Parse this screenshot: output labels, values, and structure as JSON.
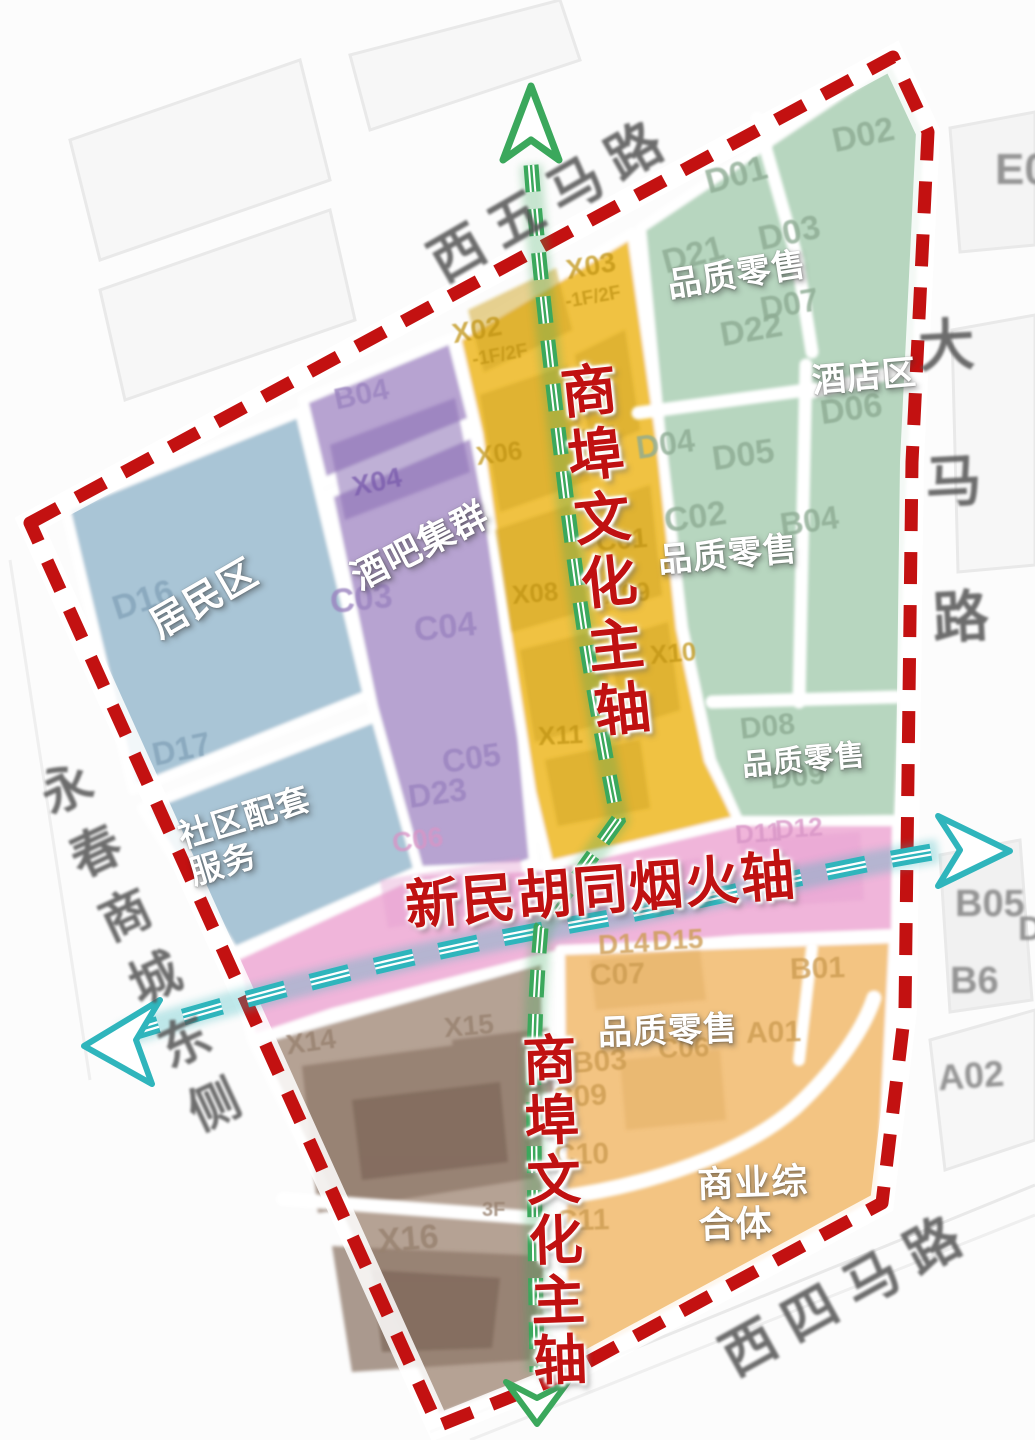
{
  "streets": {
    "top": "西五马路",
    "right": "大马路",
    "left": "永春商城东侧",
    "bottom": "西四马路"
  },
  "axes": {
    "vertical_top": "商埠文化主轴",
    "vertical_bottom": "商埠文化主轴",
    "horizontal": "新民胡同烟火轴"
  },
  "area_labels": {
    "residential": "居民区",
    "community_line1": "社区配套",
    "community_line2": "服务",
    "bar_cluster": "酒吧集群",
    "retail_top": "品质零售",
    "hotel": "酒店区",
    "retail_mid": "品质零售",
    "retail_low": "品质零售",
    "retail_south": "品质零售",
    "complex_line1": "商业综",
    "complex_line2": "合体"
  },
  "colors": {
    "boundary_red": "#c31111",
    "axis_green": "#3ba85c",
    "axis_cyan": "#2fb5bc",
    "axis_text_red": "#c01111",
    "zone_blue": "#a9c5d6",
    "zone_purple": "#b7a3d1",
    "zone_yellow": "#f0c243",
    "zone_green": "#b7d6bf",
    "zone_pink": "#f0b5da",
    "zone_orange": "#f3c482",
    "zone_brown": "#b5a294",
    "road_white": "#ffffff"
  },
  "blocks": [
    {
      "t": "D16",
      "x": 112,
      "y": 583,
      "r": -18,
      "fs": 34,
      "cls": "c-blue"
    },
    {
      "t": "D17",
      "x": 152,
      "y": 733,
      "r": -12,
      "fs": 32,
      "cls": "c-blue"
    },
    {
      "t": "B04",
      "x": 334,
      "y": 380,
      "r": -12,
      "fs": 30,
      "cls": "c-purple"
    },
    {
      "t": "X04",
      "x": 352,
      "y": 468,
      "r": -12,
      "fs": 28,
      "cls": "c-purple-dk"
    },
    {
      "t": "C03",
      "x": 330,
      "y": 582,
      "r": -6,
      "fs": 34,
      "cls": "c-purple"
    },
    {
      "t": "C04",
      "x": 414,
      "y": 610,
      "r": -6,
      "fs": 34,
      "cls": "c-purple"
    },
    {
      "t": "C05",
      "x": 442,
      "y": 742,
      "r": -8,
      "fs": 32,
      "cls": "c-purple"
    },
    {
      "t": "D23",
      "x": 408,
      "y": 777,
      "r": -8,
      "fs": 32,
      "cls": "c-purple"
    },
    {
      "t": "X02",
      "x": 452,
      "y": 316,
      "r": -10,
      "fs": 28,
      "cls": "c-yellow-dk"
    },
    {
      "t": "-1F/2F",
      "x": 472,
      "y": 346,
      "r": -10,
      "fs": 19,
      "cls": "c-yellow-dk"
    },
    {
      "t": "X03",
      "x": 566,
      "y": 252,
      "r": -10,
      "fs": 28,
      "cls": "c-yellow-dk"
    },
    {
      "t": "-1F/2F",
      "x": 565,
      "y": 288,
      "r": -10,
      "fs": 19,
      "cls": "c-yellow-dk"
    },
    {
      "t": "X06",
      "x": 476,
      "y": 440,
      "r": -8,
      "fs": 26,
      "cls": "c-yellow-dk"
    },
    {
      "t": "X07",
      "x": 570,
      "y": 424,
      "r": -8,
      "fs": 26,
      "cls": "c-yellow-dk"
    },
    {
      "t": "C01",
      "x": 596,
      "y": 526,
      "r": -5,
      "fs": 28,
      "cls": "c-yellow-dk"
    },
    {
      "t": "X08",
      "x": 512,
      "y": 580,
      "r": -5,
      "fs": 26,
      "cls": "c-yellow-dk"
    },
    {
      "t": "X09",
      "x": 604,
      "y": 580,
      "r": -5,
      "fs": 26,
      "cls": "c-yellow-dk"
    },
    {
      "t": "X10",
      "x": 650,
      "y": 640,
      "r": -5,
      "fs": 26,
      "cls": "c-yellow-dk"
    },
    {
      "t": "X11",
      "x": 538,
      "y": 722,
      "r": -3,
      "fs": 26,
      "cls": "c-yellow-dk"
    },
    {
      "t": "D01",
      "x": 705,
      "y": 158,
      "r": -15,
      "fs": 34,
      "cls": "c-green-dk"
    },
    {
      "t": "D02",
      "x": 832,
      "y": 118,
      "r": -12,
      "fs": 34,
      "cls": "c-green-dk"
    },
    {
      "t": "D21",
      "x": 662,
      "y": 238,
      "r": -15,
      "fs": 34,
      "cls": "c-green-dk"
    },
    {
      "t": "D03",
      "x": 758,
      "y": 216,
      "r": -12,
      "fs": 34,
      "cls": "c-green-dk"
    },
    {
      "t": "D07",
      "x": 760,
      "y": 288,
      "r": -10,
      "fs": 32,
      "cls": "c-green-dk"
    },
    {
      "t": "D22",
      "x": 720,
      "y": 313,
      "r": -10,
      "fs": 34,
      "cls": "c-green-dk"
    },
    {
      "t": "D06",
      "x": 820,
      "y": 392,
      "r": -8,
      "fs": 34,
      "cls": "c-green-dk"
    },
    {
      "t": "D04",
      "x": 636,
      "y": 428,
      "r": -8,
      "fs": 32,
      "cls": "c-green-dk"
    },
    {
      "t": "D05",
      "x": 712,
      "y": 438,
      "r": -8,
      "fs": 34,
      "cls": "c-green-dk"
    },
    {
      "t": "C02",
      "x": 664,
      "y": 500,
      "r": -8,
      "fs": 34,
      "cls": "c-green-dk"
    },
    {
      "t": "B04",
      "x": 780,
      "y": 505,
      "r": -8,
      "fs": 32,
      "cls": "c-green-dk"
    },
    {
      "t": "D08",
      "x": 740,
      "y": 712,
      "r": -6,
      "fs": 30,
      "cls": "c-green-dk"
    },
    {
      "t": "D09",
      "x": 770,
      "y": 762,
      "r": -6,
      "fs": 30,
      "cls": "c-green-dk"
    },
    {
      "t": "C06",
      "x": 392,
      "y": 826,
      "r": -8,
      "fs": 28,
      "cls": "c-pink-dk"
    },
    {
      "t": "D11",
      "x": 735,
      "y": 820,
      "r": -4,
      "fs": 26,
      "cls": "c-pink-dk"
    },
    {
      "t": "D12",
      "x": 775,
      "y": 815,
      "r": -4,
      "fs": 26,
      "cls": "c-pink-dk"
    },
    {
      "t": "D14",
      "x": 598,
      "y": 930,
      "r": -3,
      "fs": 28,
      "cls": "c-orange-dk"
    },
    {
      "t": "D15",
      "x": 652,
      "y": 926,
      "r": -3,
      "fs": 28,
      "cls": "c-orange-dk"
    },
    {
      "t": "C07",
      "x": 590,
      "y": 960,
      "r": -2,
      "fs": 30,
      "cls": "c-orange-dk"
    },
    {
      "t": "B01",
      "x": 790,
      "y": 954,
      "r": -2,
      "fs": 30,
      "cls": "c-orange-dk"
    },
    {
      "t": "A01",
      "x": 746,
      "y": 1018,
      "r": -2,
      "fs": 30,
      "cls": "c-orange-dk"
    },
    {
      "t": "C06",
      "x": 658,
      "y": 1034,
      "r": -2,
      "fs": 28,
      "cls": "c-orange-dk"
    },
    {
      "t": "B03",
      "x": 572,
      "y": 1047,
      "r": -4,
      "fs": 30,
      "cls": "c-orange-dk"
    },
    {
      "t": "C09",
      "x": 552,
      "y": 1082,
      "r": -4,
      "fs": 30,
      "cls": "c-orange-dk"
    },
    {
      "t": "C10",
      "x": 554,
      "y": 1140,
      "r": -2,
      "fs": 30,
      "cls": "c-orange-dk"
    },
    {
      "t": "C11",
      "x": 556,
      "y": 1206,
      "r": -2,
      "fs": 30,
      "cls": "c-orange-dk"
    },
    {
      "t": "X14",
      "x": 286,
      "y": 1028,
      "r": -8,
      "fs": 28,
      "cls": "c-brown-dk"
    },
    {
      "t": "X15",
      "x": 444,
      "y": 1012,
      "r": -5,
      "fs": 28,
      "cls": "c-brown-dk"
    },
    {
      "t": "X16",
      "x": 378,
      "y": 1222,
      "r": -5,
      "fs": 34,
      "cls": "c-brown-dk"
    },
    {
      "t": "3F",
      "x": 482,
      "y": 1200,
      "r": 0,
      "fs": 20,
      "cls": "c-brown-dk"
    },
    {
      "t": "E0",
      "x": 995,
      "y": 148,
      "r": 0,
      "fs": 44,
      "cls": "c-out"
    },
    {
      "t": "B05",
      "x": 955,
      "y": 885,
      "r": 0,
      "fs": 38,
      "cls": "c-out"
    },
    {
      "t": "B6",
      "x": 950,
      "y": 962,
      "r": 0,
      "fs": 38,
      "cls": "c-out"
    },
    {
      "t": "A02",
      "x": 938,
      "y": 1058,
      "r": -4,
      "fs": 36,
      "cls": "c-out"
    },
    {
      "t": "D",
      "x": 1018,
      "y": 912,
      "r": 0,
      "fs": 34,
      "cls": "c-out"
    }
  ]
}
